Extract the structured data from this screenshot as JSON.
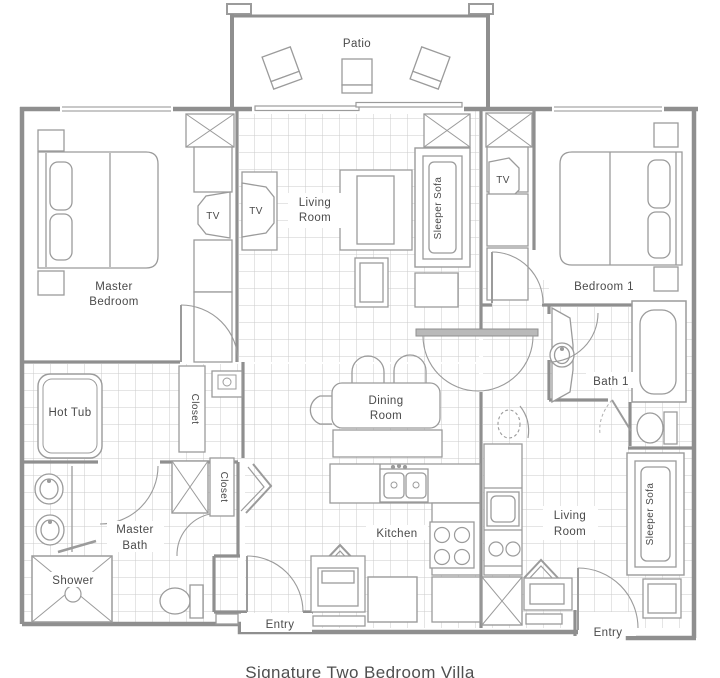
{
  "caption": "Signature Two Bedroom Villa",
  "colors": {
    "wall": "#8f8f8f",
    "furniture_line": "#9b9b9b",
    "tile_line": "#cbcbcb",
    "text": "#4a4a4a",
    "background": "#ffffff"
  },
  "rooms": {
    "patio": {
      "label": "Patio"
    },
    "living_room_main": {
      "line1": "Living",
      "line2": "Room"
    },
    "master_bedroom": {
      "line1": "Master",
      "line2": "Bedroom"
    },
    "bedroom_1": {
      "label": "Bedroom 1"
    },
    "dining_room": {
      "line1": "Dining",
      "line2": "Room"
    },
    "kitchen": {
      "label": "Kitchen"
    },
    "master_bath": {
      "line1": "Master",
      "line2": "Bath"
    },
    "bath_1": {
      "label": "Bath 1"
    },
    "living_room_suite": {
      "line1": "Living",
      "line2": "Room"
    },
    "entry": {
      "label": "Entry"
    }
  },
  "fixtures": {
    "tv": "TV",
    "sleeper_sofa": "Sleeper Sofa",
    "hot_tub": "Hot Tub",
    "closet": "Closet",
    "shower": "Shower"
  }
}
